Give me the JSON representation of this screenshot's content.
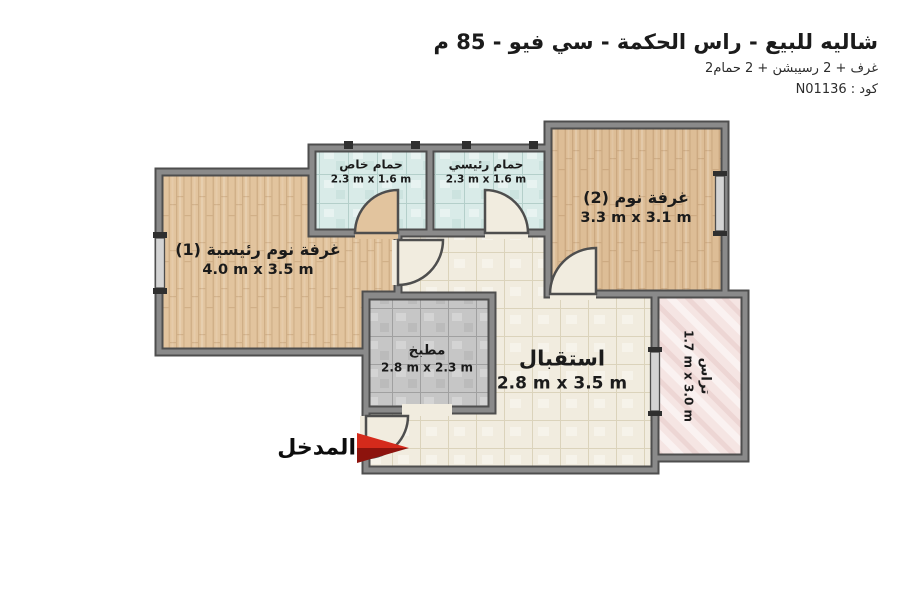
{
  "header": {
    "title": "شاليه للبيع - راس الحكمة - سي فيو - 85 م",
    "subtitle": "2غرف + 2 رسيبشن + 2 حمام",
    "code_line": "كود : N01136"
  },
  "rooms": {
    "master_bedroom": {
      "name": "غرفة نوم رئيسية (1)",
      "dims": "4.0 m x 3.5 m",
      "floor_color": "#e2c49e"
    },
    "private_bathroom": {
      "name": "حمام خاص",
      "dims": "2.3 m x 1.6 m",
      "floor_color": "#d9ebe8"
    },
    "main_bathroom": {
      "name": "حمام رئيسي",
      "dims": "2.3 m x 1.6 m",
      "floor_color": "#d9ebe8"
    },
    "bedroom_2": {
      "name": "غرفة نوم (2)",
      "dims": "3.3 m x 3.1 m",
      "floor_color": "#ddbd96"
    },
    "kitchen": {
      "name": "مطبخ",
      "dims": "2.8 m x 2.3 m",
      "floor_color": "#c6c6c6"
    },
    "reception": {
      "name": "استقبال",
      "dims": "2.8 m x 3.5 m",
      "floor_color": "#f1ecdf"
    },
    "terrace": {
      "name": "تراس",
      "dims": "1.7 m x 3.0 m",
      "floor_color": "#f5e5e3"
    }
  },
  "entrance": {
    "label": "المدخل",
    "arrow_color": "#d52a1b",
    "arrow_shadow_color": "#8d130d"
  },
  "colors": {
    "background": "#ffffff",
    "wall_core": "#8a8a8a",
    "wall_edge": "#4e4e4e",
    "window_fill": "#d4d4d4",
    "window_cap": "#2f2f2f",
    "label_text": "#1b1b1b"
  }
}
